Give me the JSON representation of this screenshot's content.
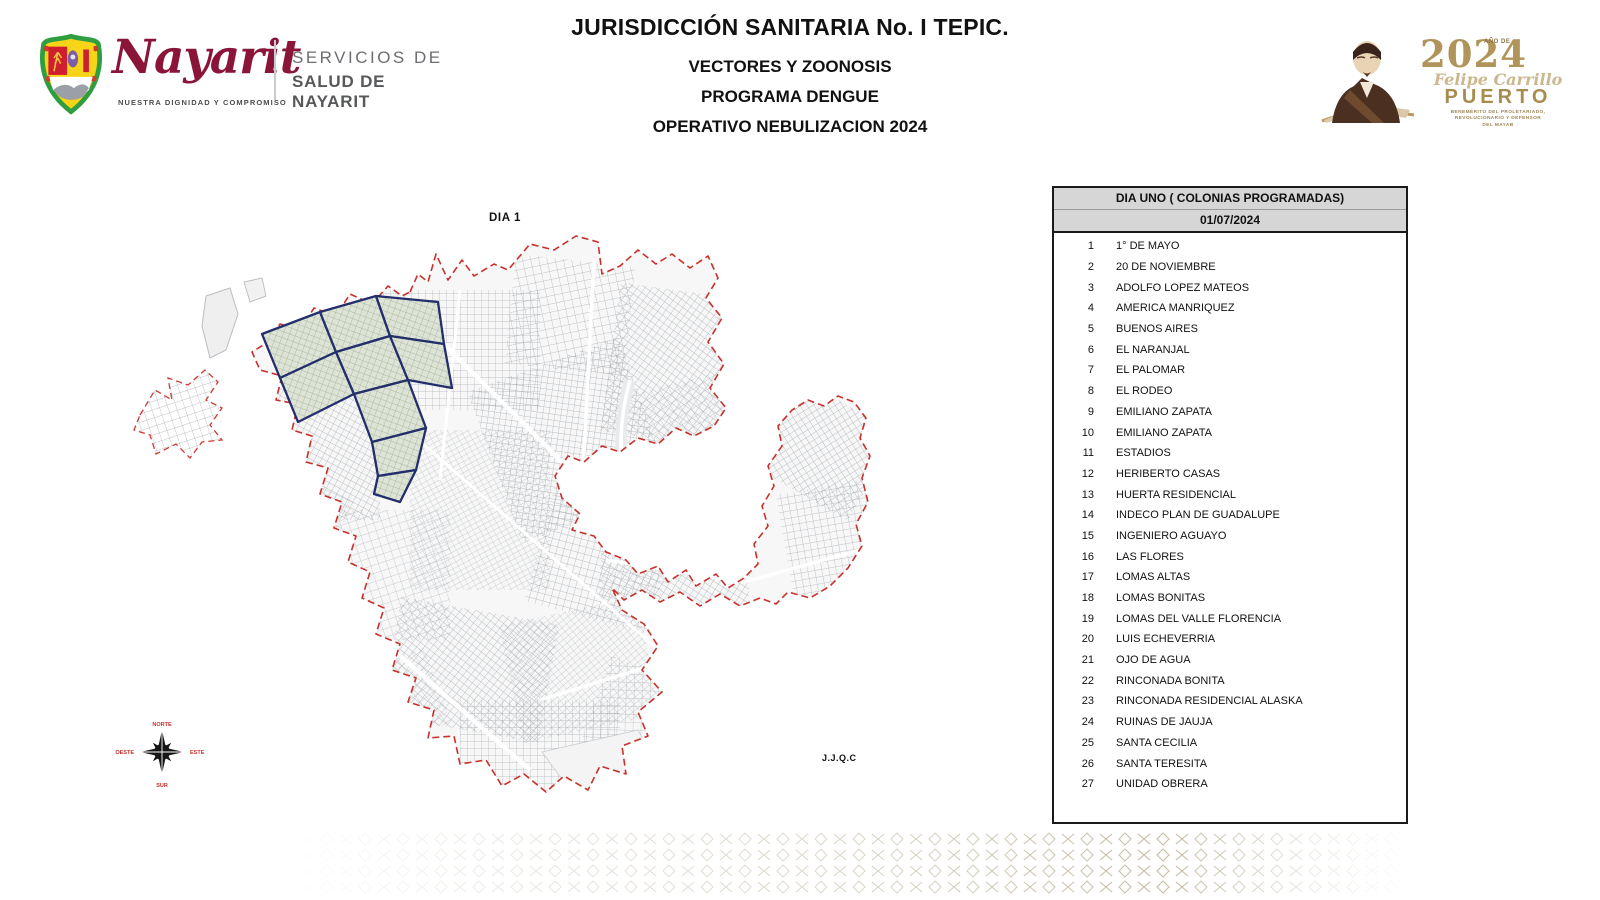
{
  "header": {
    "title": "JURISDICCIÓN SANITARIA No. I TEPIC.",
    "subtitles": [
      "VECTORES Y ZOONOSIS",
      "PROGRAMA DENGUE",
      "OPERATIVO NEBULIZACION 2024"
    ],
    "left_logo": {
      "brand_script": "Nayarit",
      "tagline": "NUESTRA DIGNIDAD Y COMPROMISO",
      "org_line1": "SERVICIOS DE",
      "org_line2": "SALUD DE NAYARIT"
    },
    "right_logo": {
      "year_prefix": "AÑO DE",
      "year": "2024",
      "name_script": "Felipe Carrillo",
      "name_caps": "PUERTO",
      "legend_lines": [
        "BENEMÉRITO DEL PROLETARIADO,",
        "REVOLUCIONARIO Y DEFENSOR",
        "DEL MAYAB"
      ]
    }
  },
  "map": {
    "day_label": "DIA 1",
    "credit": "J.J.Q.C",
    "compass": {
      "north": "NORTE",
      "south": "SUR",
      "east": "ESTE",
      "west": "OESTE"
    },
    "colors": {
      "boundary_red": "#c9302c",
      "highlight_navy": "#232e6a",
      "highlight_fill": "#dde4d6",
      "street_gray": "#9aa1a7"
    }
  },
  "table": {
    "header_line1": "DIA UNO ( COLONIAS PROGRAMADAS)",
    "header_line2": "01/07/2024",
    "rows": [
      {
        "num": "1",
        "name": "1° DE MAYO"
      },
      {
        "num": "2",
        "name": "20 DE NOVIEMBRE"
      },
      {
        "num": "3",
        "name": "ADOLFO LOPEZ MATEOS"
      },
      {
        "num": "4",
        "name": "AMERICA MANRIQUEZ"
      },
      {
        "num": "5",
        "name": "BUENOS AIRES"
      },
      {
        "num": "6",
        "name": "EL NARANJAL"
      },
      {
        "num": "7",
        "name": "EL PALOMAR"
      },
      {
        "num": "8",
        "name": "EL RODEO"
      },
      {
        "num": "9",
        "name": "EMILIANO ZAPATA"
      },
      {
        "num": "10",
        "name": "EMILIANO ZAPATA"
      },
      {
        "num": "11",
        "name": "ESTADIOS"
      },
      {
        "num": "12",
        "name": "HERIBERTO CASAS"
      },
      {
        "num": "13",
        "name": "HUERTA RESIDENCIAL"
      },
      {
        "num": "14",
        "name": "INDECO PLAN DE GUADALUPE"
      },
      {
        "num": "15",
        "name": "INGENIERO AGUAYO"
      },
      {
        "num": "16",
        "name": "LAS FLORES"
      },
      {
        "num": "17",
        "name": "LOMAS ALTAS"
      },
      {
        "num": "18",
        "name": "LOMAS BONITAS"
      },
      {
        "num": "19",
        "name": "LOMAS DEL VALLE FLORENCIA"
      },
      {
        "num": "20",
        "name": "LUIS ECHEVERRIA"
      },
      {
        "num": "21",
        "name": "OJO DE AGUA"
      },
      {
        "num": "22",
        "name": "RINCONADA BONITA"
      },
      {
        "num": "23",
        "name": "RINCONADA RESIDENCIAL ALASKA"
      },
      {
        "num": "24",
        "name": "RUINAS DE JAUJA"
      },
      {
        "num": "25",
        "name": "SANTA CECILIA"
      },
      {
        "num": "26",
        "name": "SANTA TERESITA"
      },
      {
        "num": "27",
        "name": "UNIDAD OBRERA"
      }
    ]
  }
}
